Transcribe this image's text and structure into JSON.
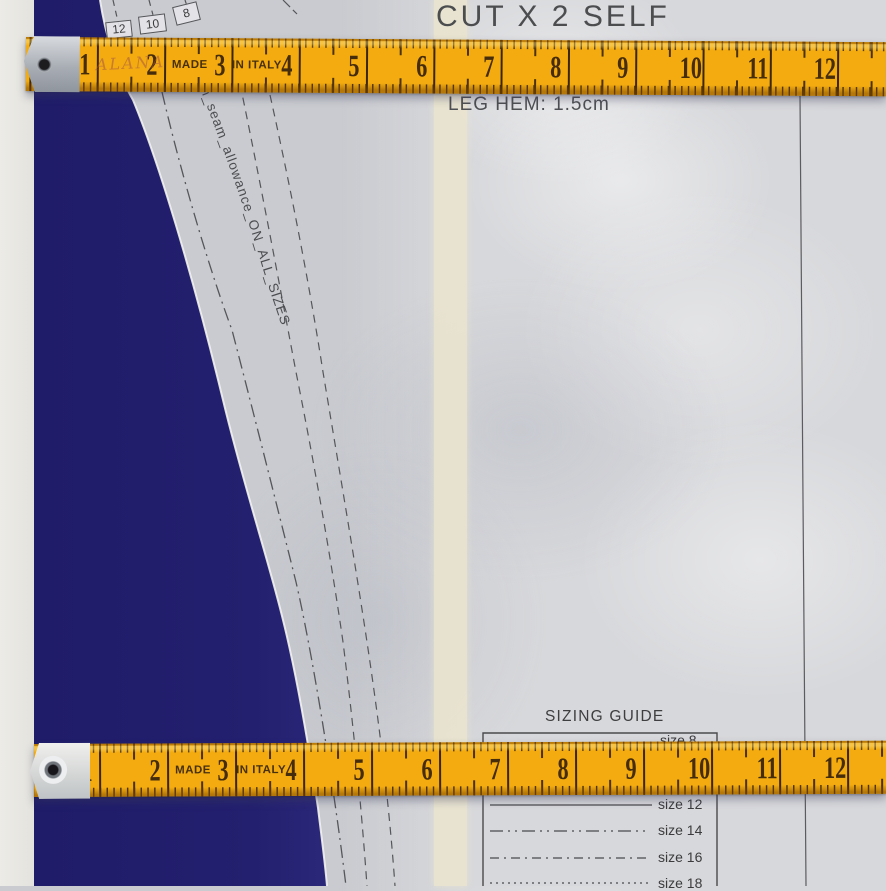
{
  "heading": {
    "cut_label": "CUT X 2 SELF",
    "hem_label": "LEG HEM: 1.5cm"
  },
  "pattern_paper": {
    "seam_note": "m_seam_allowance_ON_ALL_SIZES",
    "size_flags": [
      {
        "label": "12"
      },
      {
        "label": "10"
      },
      {
        "label": "8"
      }
    ]
  },
  "measuring_tape": {
    "made_label": "MADE",
    "in_italy_label": "IN ITALY",
    "handwriting": "ALANA",
    "numbers": [
      "1",
      "2",
      "3",
      "4",
      "5",
      "6",
      "7",
      "8",
      "9",
      "10",
      "11",
      "12"
    ]
  },
  "sizing_guide": {
    "title": "SIZING GUIDE",
    "partial_row_label": "size 8",
    "rows": [
      {
        "label": "size 12",
        "line_style": "solid"
      },
      {
        "label": "size 14",
        "line_style": "dash-dot-dot"
      },
      {
        "label": "size 16",
        "line_style": "dash-dot"
      },
      {
        "label": "size 18",
        "line_style": "dotted"
      }
    ]
  },
  "colors": {
    "tape_yellow": "#f3ab10",
    "fabric_navy": "#221f70",
    "paper_grey": "#d7d8db",
    "table_white": "#ecebe6",
    "cream_strip": "#ebe5cf"
  }
}
